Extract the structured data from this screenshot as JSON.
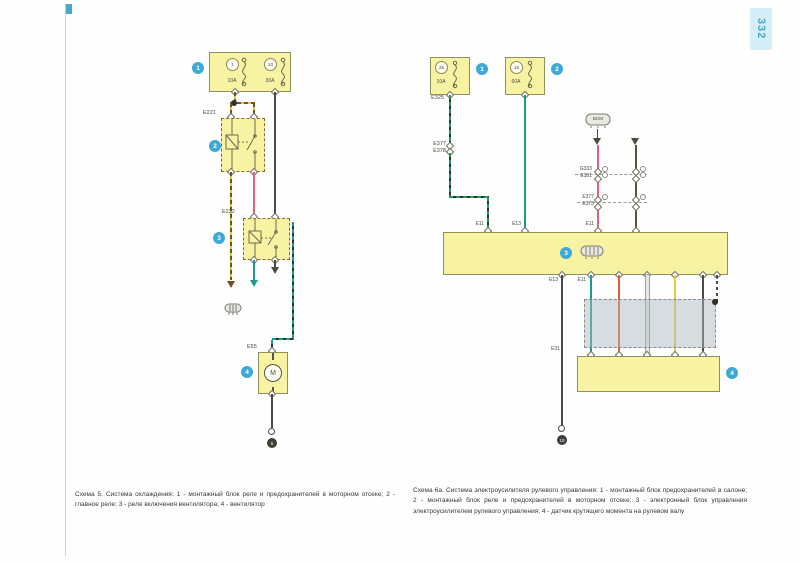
{
  "page": {
    "number": "332",
    "captions": {
      "left": "Схема 5. Система охлаждения: 1 - монтажный блок реле и предохранителей в моторном отсеке; 2 - главное реле; 3 - реле включения вентилятора; 4 - вентилятор",
      "right": "Схема 6а. Система электроусилителя рулевого управления: 1 - монтажный блок предохранителей в салоне; 2 - монтажный блок реле и предохранителей в моторном отсеке; 3 - электронный блок управления электроусилителем рулевого управления; 4 - датчик крутящего момента на рулевом валу"
    }
  },
  "palette": {
    "yellow_fill": "#f8f3a2",
    "box_border": "#90905e",
    "relay_border": "#8b6b2f",
    "callout": "#3fa9d5",
    "wire_dark": "#4b4b41",
    "wire_brown_dark": "#5a5044",
    "wire_pink": "#e0607d",
    "wire_teal": "#1a9d8b",
    "wire_green": "#1a9e72",
    "wire_orange": "#df5f35",
    "wire_yellow": "#e2cf3e",
    "wire_white": "#e6e8e2",
    "dash_brown": "#7a4a20",
    "dash_yellow": "#e2c63e",
    "dash_black": "#30302c",
    "shield_grey": "#acb8c0",
    "page_blue": "#49a7cc",
    "tab_bg": "#d6eef8"
  },
  "left": {
    "fusebox": {
      "callout": "1",
      "fuse1_num": "1",
      "fuse1_amps": "10A",
      "fuse2_num": "10",
      "fuse2_amps": "30A"
    },
    "relay1_label": "E221",
    "relay1_callout": "2",
    "relay2_label": "E222",
    "relay2_callout": "3",
    "motor_label": "E55",
    "motor_callout": "4",
    "motor_symbol": "M",
    "ground_num": "5"
  },
  "right": {
    "fusebox1": {
      "callout": "1",
      "fuse_num": "26",
      "amps": "10A"
    },
    "fusebox2": {
      "callout": "2",
      "fuse_num": "18",
      "amps": "60A"
    },
    "labels": {
      "e325": "E325",
      "e377_1": "E377",
      "e378_1": "E378",
      "g333": "G333",
      "e381": "E381",
      "e377_2": "E377",
      "e378_2": "E378",
      "e11_top": "E11",
      "e13_top": "E13",
      "e11_right": "E11",
      "e13_out": "E13",
      "e11_out": "E11",
      "e31": "E31",
      "bcm": "BCM"
    },
    "ecu_callout": "3",
    "sensor_callout": "4",
    "ground_num": "10"
  }
}
